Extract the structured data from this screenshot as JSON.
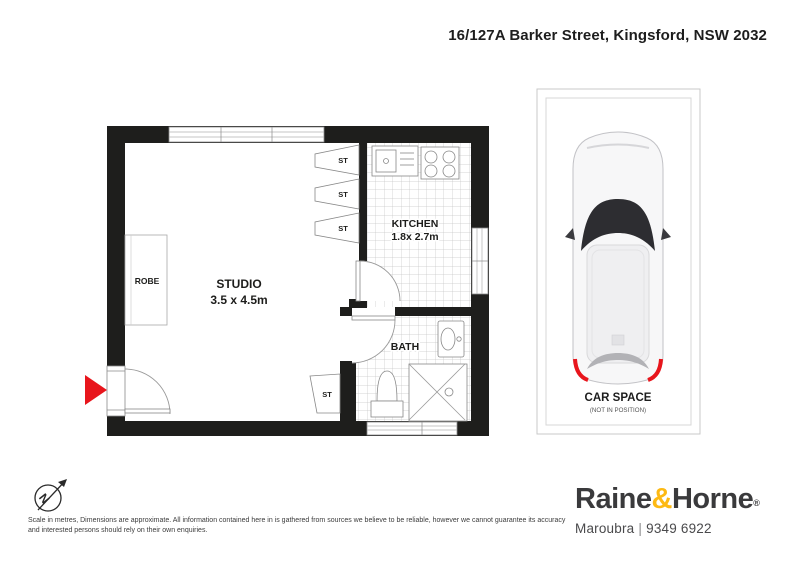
{
  "header": {
    "address": "16/127A Barker Street, Kingsford, NSW 2032"
  },
  "floorplan": {
    "studio": {
      "name": "STUDIO",
      "dimensions": "3.5 x 4.5m"
    },
    "kitchen": {
      "name": "KITCHEN",
      "dimensions": "1.8x 2.7m"
    },
    "bath": {
      "name": "BATH"
    },
    "robe": {
      "name": "ROBE"
    },
    "storage_label": "ST"
  },
  "car_space": {
    "name": "CAR SPACE",
    "note": "(NOT IN POSITION)"
  },
  "compass": {
    "north_label": "N"
  },
  "disclaimer": "Scale in metres, Dimensions are approximate. All information contained here in is gathered from sources we believe to be reliable, however we cannot guarantee its accuracy and interested persons should rely on their own enquiries.",
  "brand": {
    "name_left": "Raine",
    "ampersand": "&",
    "name_right": "Horne",
    "registered_mark": "®",
    "office": "Maroubra",
    "separator": "|",
    "phone": "9349 6922"
  },
  "colors": {
    "wall": "#1E1E1C",
    "entry_arrow": "#E8151C",
    "brand_accent": "#FDB913",
    "brand_text": "#3A3A3C"
  }
}
